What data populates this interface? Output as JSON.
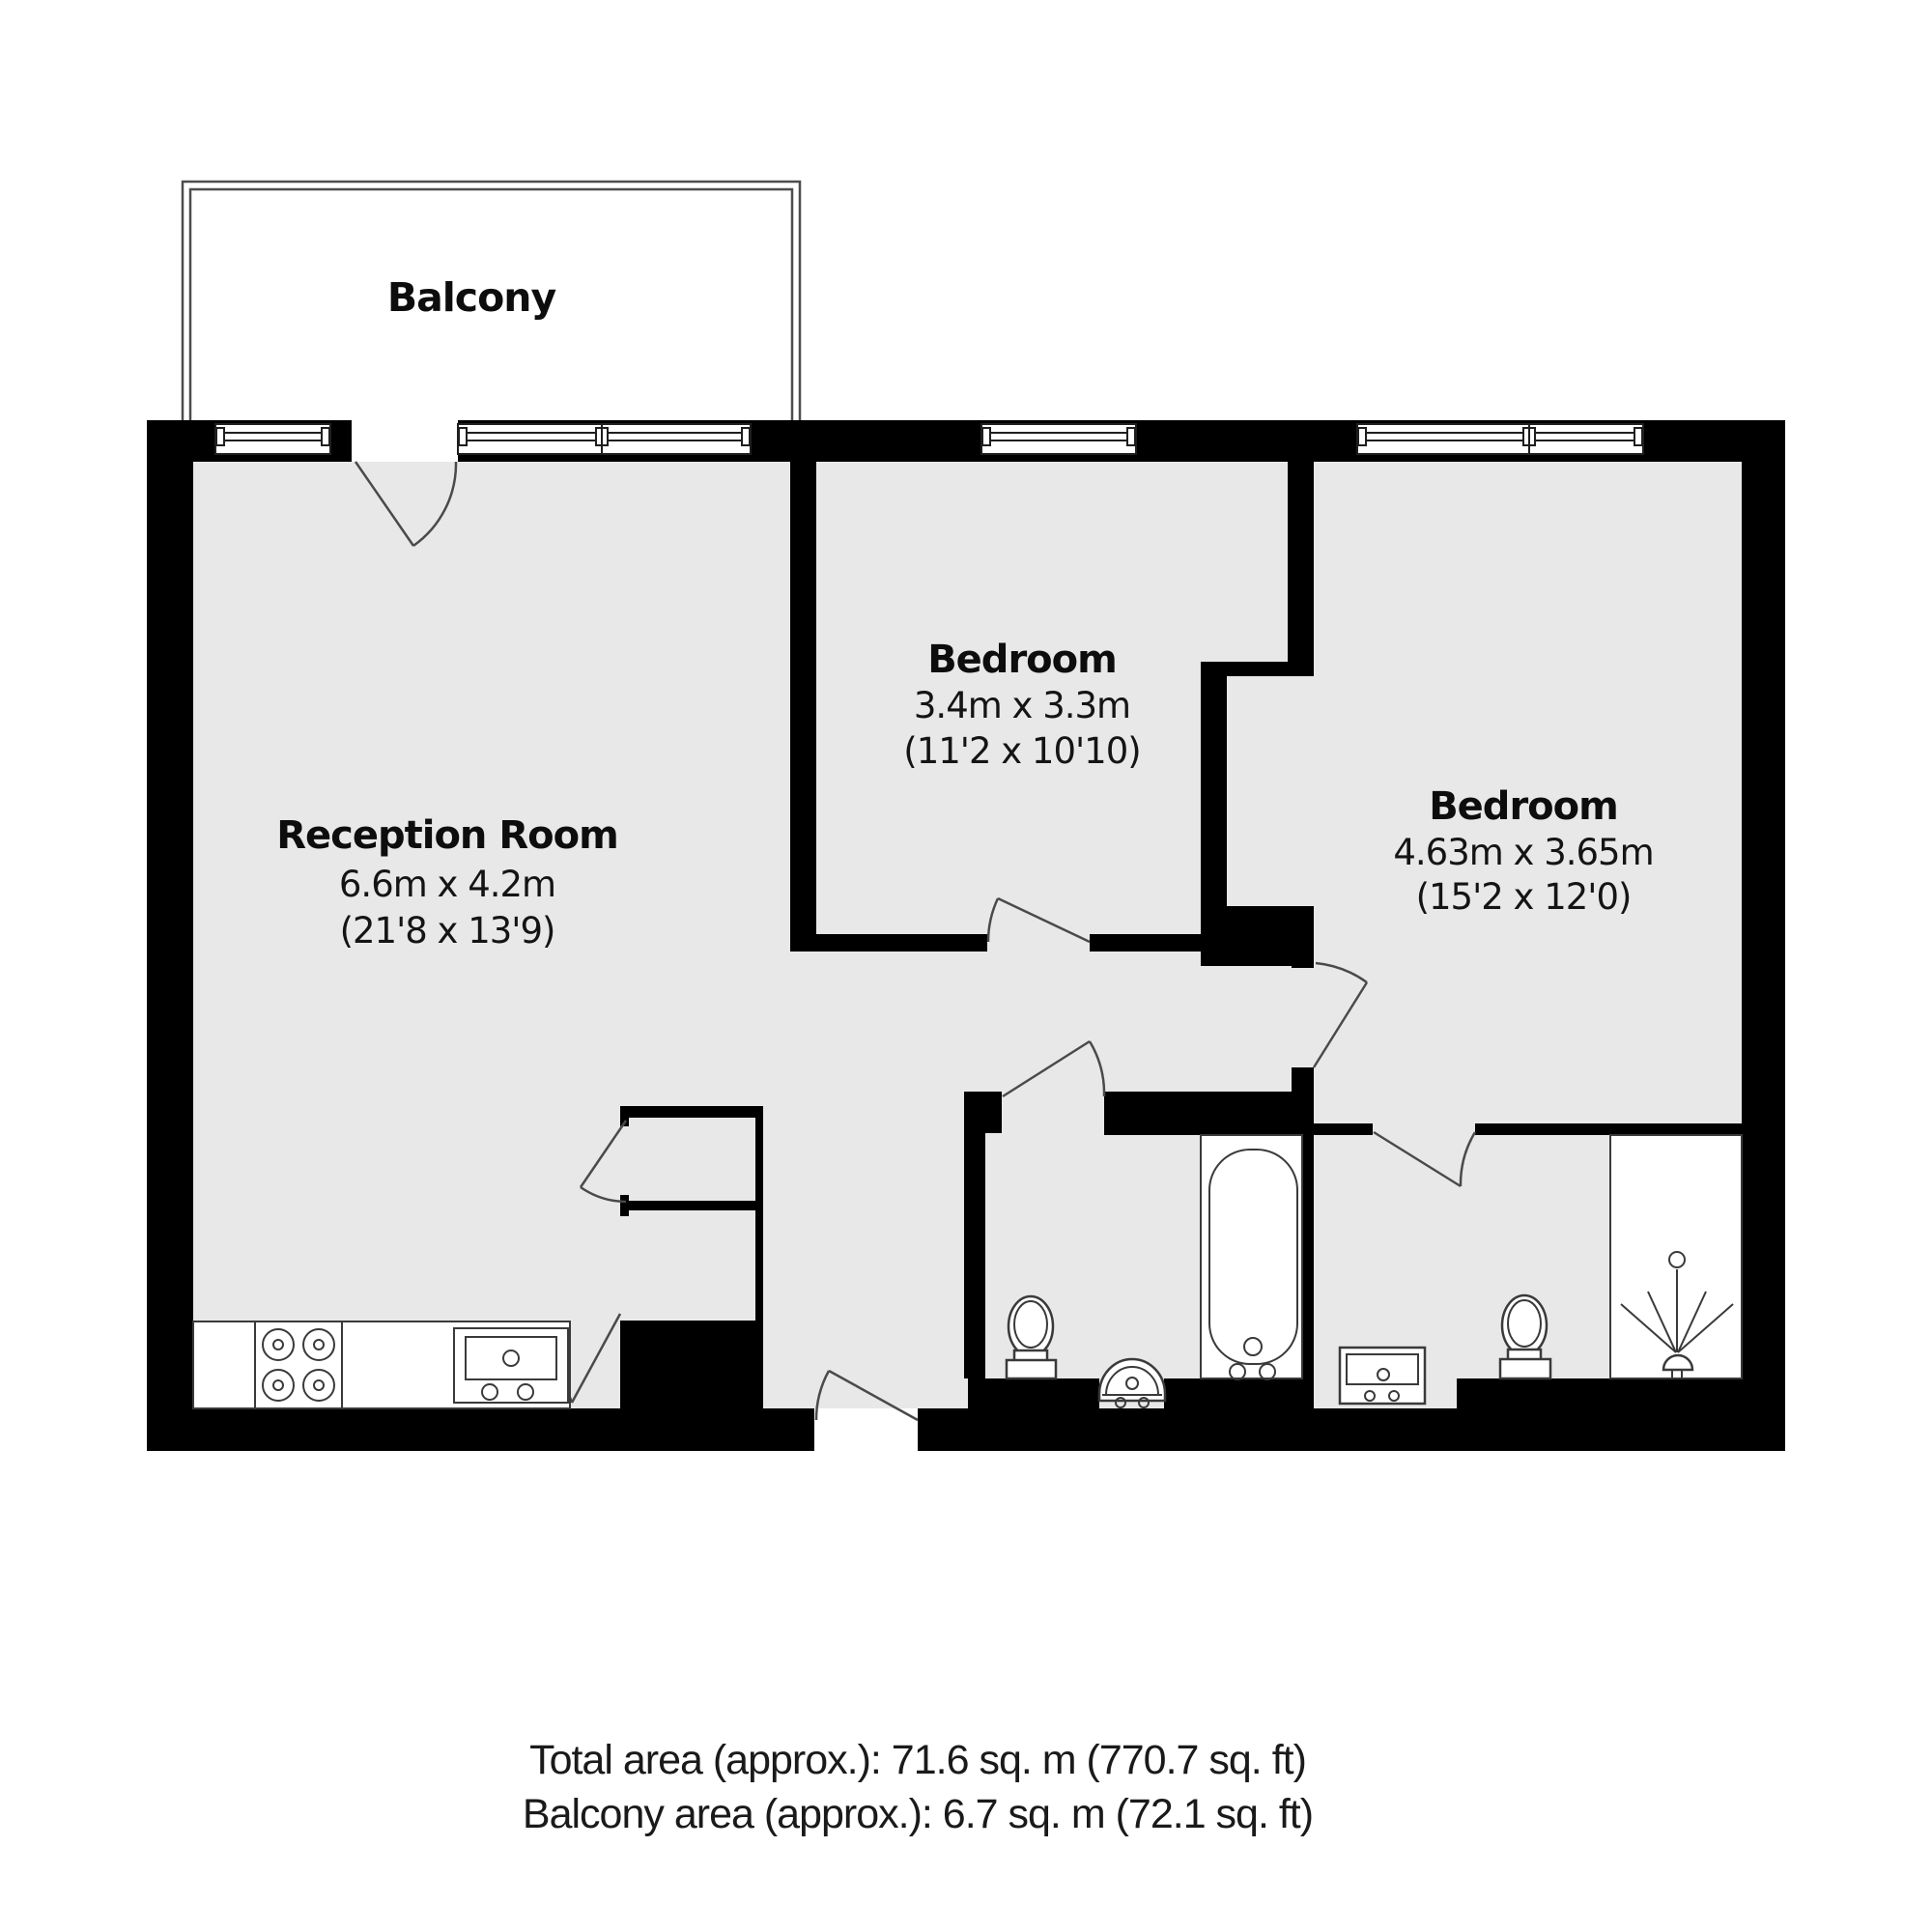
{
  "plan": {
    "balcony_label": "Balcony",
    "rooms": [
      {
        "id": "reception",
        "name": "Reception Room",
        "dim_metric": "6.6m x 4.2m",
        "dim_imperial": "(21'8 x 13'9)"
      },
      {
        "id": "bedroom-1",
        "name": "Bedroom",
        "dim_metric": "3.4m x 3.3m",
        "dim_imperial": "(11'2 x 10'10)"
      },
      {
        "id": "bedroom-2",
        "name": "Bedroom",
        "dim_metric": "4.63m x 3.65m",
        "dim_imperial": "(15'2 x 12'0)"
      }
    ],
    "footer": {
      "total_area": "Total area (approx.): 71.6 sq. m (770.7 sq. ft)",
      "balcony_area": "Balcony area (approx.): 6.7 sq. m (72.1 sq. ft)"
    },
    "colors": {
      "wall": "#000000",
      "floor": "#e8e8e8",
      "fixture_line": "#3a3a3a",
      "background": "#ffffff"
    }
  }
}
